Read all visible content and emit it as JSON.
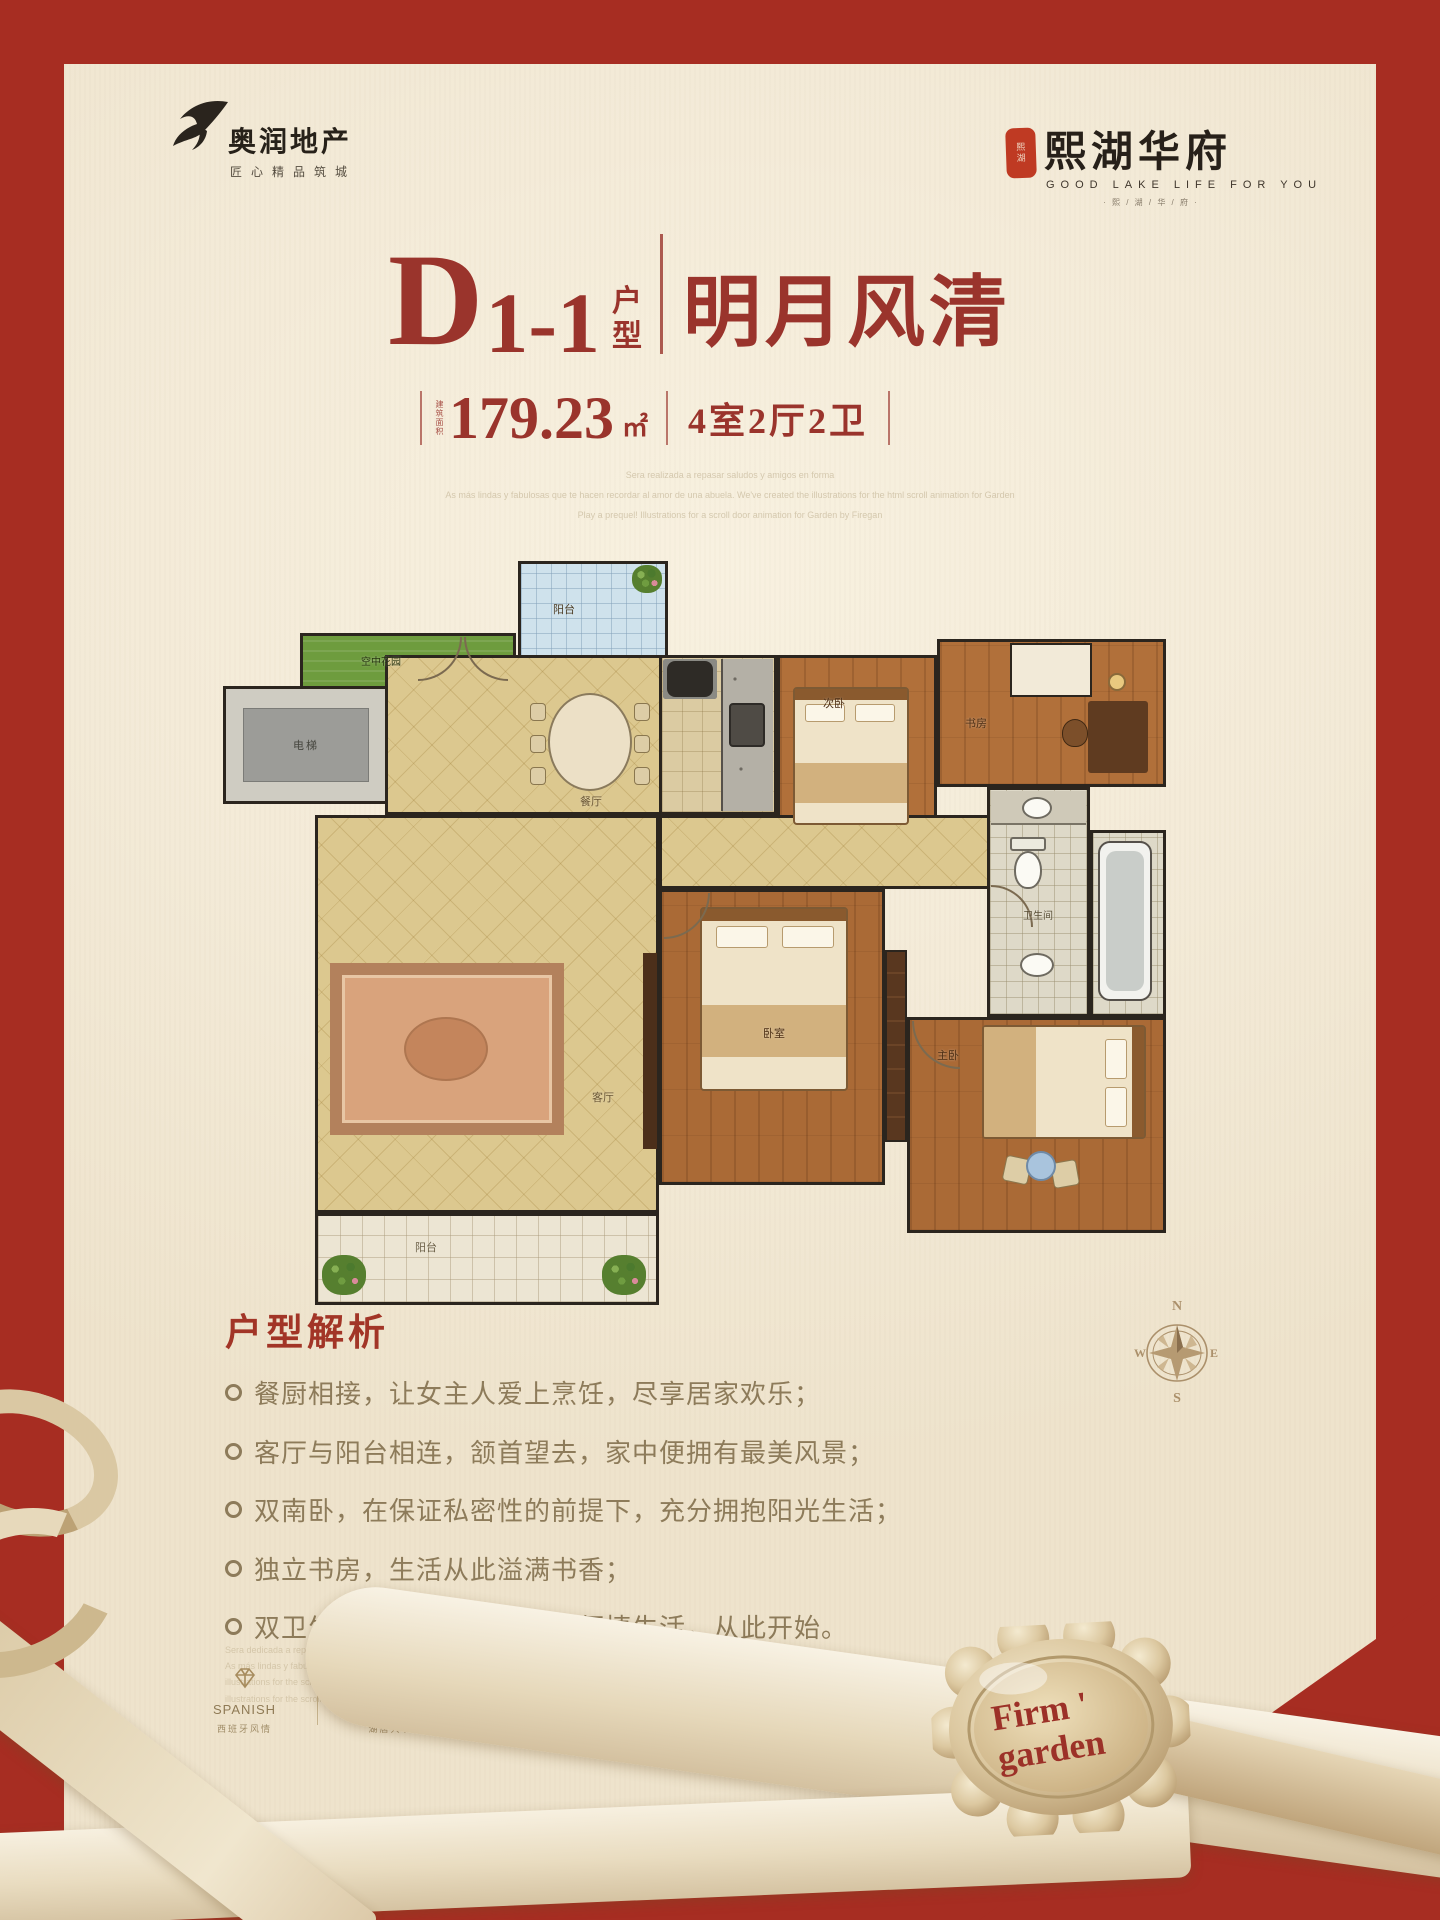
{
  "branding": {
    "developer": {
      "name": "奥润地产",
      "tagline": "匠心精品筑城"
    },
    "project": {
      "seal_chars": "熙湖",
      "name": "熙湖华府",
      "tagline_en": "GOOD LAKE LIFE FOR YOU",
      "tagline_deco": "· 熙 / 湖 / 华 / 府 ·"
    }
  },
  "title": {
    "letter": "D",
    "number": "1-1",
    "suffix": "户型",
    "name": "明月风清"
  },
  "specs": {
    "area_label": "建筑面积",
    "area": "179.23",
    "unit": "㎡",
    "rooms": "4室2厅2卫"
  },
  "intro_lines": [
    "Sera realizada a repasar saludos y amigos en forma",
    "As más lindas y fabulosas que te hacen recordar al amor de una abuela. We've created the illustrations for the html scroll animation for Garden",
    "Play a prequel! Illustrations for a scroll door animation for Garden by Firegan"
  ],
  "floorplan": {
    "rooms": {
      "balcony_top": "阳台",
      "sky_garden": "空中花园",
      "elevator": "电梯",
      "dining": "餐厅",
      "bedroom2": "次卧",
      "study": "书房",
      "bath": "卫生间",
      "bedroom": "卧室",
      "master": "主卧",
      "living": "客厅",
      "balcony_bottom": "阳台"
    },
    "compass": {
      "n": "N",
      "e": "E",
      "s": "S",
      "w": "W"
    }
  },
  "analysis": {
    "heading": "户型解析",
    "bullets": [
      "餐厨相接，让女主人爱上烹饪，尽享居家欢乐；",
      "客厅与阳台相连，颔首望去，家中便拥有最美风景；",
      "双南卧，在保证私密性的前提下，充分拥抱阳光生活；",
      "独立书房，生活从此溢满书香；",
      "双卫生间配备，布局合理，便捷生活，从此开始。"
    ],
    "footnote_lines": [
      "Sera dedicada a repasar saludos y amor por las flores",
      "As más lindas y fabulosas que te hacen recordar al amor de una abuela. Where created the",
      "illustrations for the scroll about animation for Garden by Firegan",
      "illustrations for the scroll about animation for Garden"
    ]
  },
  "features": [
    {
      "en": "SPANISH",
      "cn": "西班牙风情"
    },
    {
      "en": "THELAKE",
      "cn": "湖居大境"
    },
    {
      "en": "GARDENS",
      "cn": "园林景观"
    },
    {
      "en": "SUPPORTING",
      "cn": "完善配套"
    }
  ],
  "seal": {
    "line1": "Firm '",
    "line2": "garden"
  }
}
